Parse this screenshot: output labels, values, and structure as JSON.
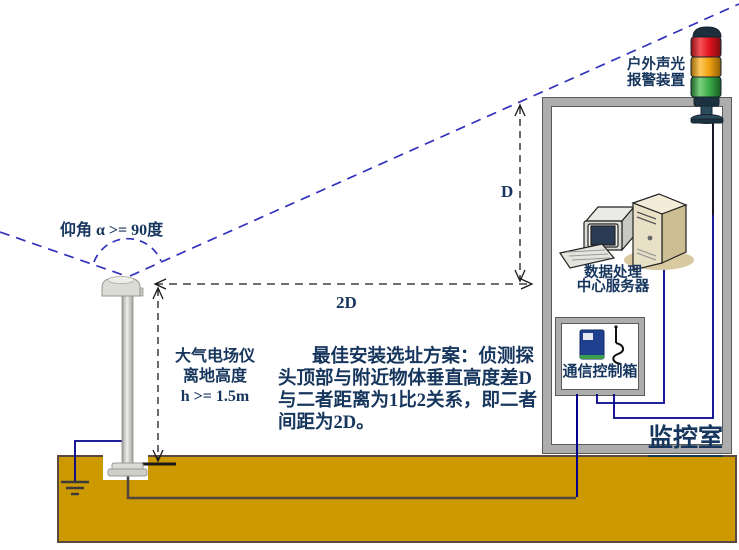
{
  "sensor": {
    "angle_label": "仰角 α >= 90度",
    "height_label_lines": [
      "大气电场仪",
      "离地高度",
      "h >= 1.5m"
    ]
  },
  "dimensions": {
    "vertical": "D",
    "horizontal": "2D"
  },
  "note_lines": [
    "最佳安装选址方案：侦测探",
    "头顶部与附近物体垂直高度差D",
    "与二者距离为1比2关系，即二者",
    "间距为2D。"
  ],
  "monitor_room": {
    "room_label": "监控室",
    "alarm_label_lines": [
      "户外声光",
      "报警装置"
    ],
    "server_label_lines": [
      "数据处理",
      "中心服务器"
    ],
    "comm_box_label": "通信控制箱"
  },
  "icons": {
    "alarm": "signal-tower-light-icon",
    "server": "computer-and-server-icon",
    "comm_device": "gsm-modem-antenna-icon",
    "grounding": "earth-ground-symbol-icon",
    "sensor": "field-mill-sensor-on-pole-icon"
  },
  "colors": {
    "text_navy": "#17365d",
    "sight_line_blue": "#3333bb",
    "dimension_black": "#1a1a1a",
    "wire_blue": "#00008b",
    "ground_gold": "#cc9900",
    "ground_border": "#5a4a42",
    "wall_gray": "#adadad",
    "alarm_red": "#e4141e",
    "alarm_amber": "#f2a211",
    "alarm_green": "#3cae49"
  }
}
